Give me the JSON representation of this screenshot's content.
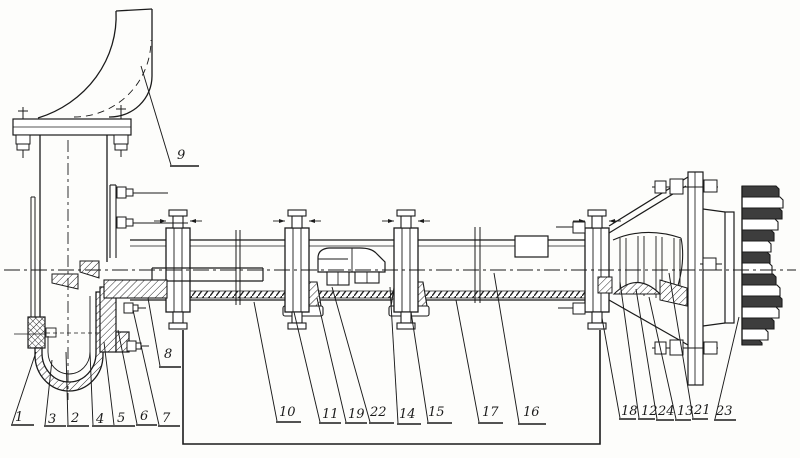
{
  "diagram": {
    "kind": "pump-assembly-technical-drawing",
    "background": "#fdfdfb",
    "ink": "#1b1b1b",
    "dark_fill": "#3d3d3d",
    "callouts": [
      {
        "label": "9",
        "text": [
          177,
          159
        ],
        "underline": [
          170,
          199,
          166
        ],
        "target": [
          141,
          66
        ]
      },
      {
        "label": "1",
        "text": [
          15,
          421
        ],
        "underline": [
          11,
          34,
          425
        ],
        "target": [
          36,
          352
        ]
      },
      {
        "label": "3",
        "text": [
          48,
          423
        ],
        "underline": [
          44,
          66,
          426
        ],
        "target": [
          52,
          360
        ]
      },
      {
        "label": "2",
        "text": [
          71,
          422
        ],
        "underline": [
          67,
          89,
          426
        ],
        "target": [
          66,
          352
        ]
      },
      {
        "label": "4",
        "text": [
          96,
          423
        ],
        "underline": [
          92,
          113,
          426
        ],
        "target": [
          90,
          352
        ]
      },
      {
        "label": "5",
        "text": [
          117,
          422
        ],
        "underline": [
          113,
          135,
          426
        ],
        "target": [
          104,
          342
        ]
      },
      {
        "label": "6",
        "text": [
          140,
          420
        ],
        "underline": [
          136,
          157,
          425
        ],
        "target": [
          118,
          330
        ]
      },
      {
        "label": "7",
        "text": [
          162,
          422
        ],
        "underline": [
          158,
          180,
          426
        ],
        "target": [
          133,
          310
        ]
      },
      {
        "label": "8",
        "text": [
          164,
          358
        ],
        "underline": [
          159,
          181,
          367
        ],
        "target": [
          148,
          298
        ]
      },
      {
        "label": "10",
        "text": [
          279,
          416
        ],
        "underline": [
          276,
          301,
          422
        ],
        "target": [
          254,
          302
        ]
      },
      {
        "label": "11",
        "text": [
          322,
          418
        ],
        "underline": [
          319,
          341,
          423
        ],
        "target": [
          294,
          312
        ]
      },
      {
        "label": "19",
        "text": [
          348,
          418
        ],
        "underline": [
          345,
          367,
          423
        ],
        "target": [
          317,
          298
        ]
      },
      {
        "label": "22",
        "text": [
          370,
          416
        ],
        "underline": [
          369,
          394,
          423
        ],
        "target": [
          332,
          287
        ]
      },
      {
        "label": "14",
        "text": [
          399,
          418
        ],
        "underline": [
          397,
          421,
          424
        ],
        "target": [
          390,
          287
        ]
      },
      {
        "label": "15",
        "text": [
          428,
          416
        ],
        "underline": [
          427,
          452,
          423
        ],
        "target": [
          411,
          312
        ]
      },
      {
        "label": "17",
        "text": [
          482,
          416
        ],
        "underline": [
          478,
          503,
          423
        ],
        "target": [
          456,
          300
        ]
      },
      {
        "label": "16",
        "text": [
          523,
          416
        ],
        "underline": [
          518,
          546,
          424
        ],
        "target": [
          494,
          273
        ]
      },
      {
        "label": "18",
        "text": [
          621,
          415
        ],
        "underline": [
          619,
          636,
          419
        ],
        "target": [
          602,
          318
        ]
      },
      {
        "label": "12",
        "text": [
          641,
          415
        ],
        "underline": [
          638,
          655,
          419
        ],
        "target": [
          620,
          282
        ]
      },
      {
        "label": "24",
        "text": [
          658,
          415
        ],
        "underline": [
          656,
          674,
          420
        ],
        "target": [
          636,
          289
        ]
      },
      {
        "label": "13",
        "text": [
          677,
          415
        ],
        "underline": [
          675,
          691,
          420
        ],
        "target": [
          649,
          297
        ]
      },
      {
        "label": "21",
        "text": [
          694,
          414
        ],
        "underline": [
          692,
          708,
          419
        ],
        "target": [
          669,
          273
        ]
      },
      {
        "label": "23",
        "text": [
          716,
          415
        ],
        "underline": [
          714,
          736,
          420
        ],
        "target": [
          739,
          317
        ]
      }
    ]
  }
}
